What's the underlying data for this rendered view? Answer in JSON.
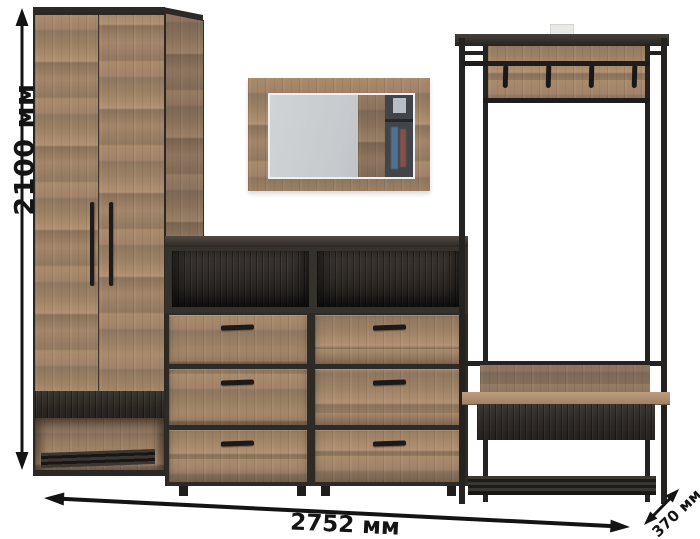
{
  "image": {
    "background": "#ffffff",
    "subject": "Hallway furniture set render: wardrobe, wall mirror, chest of drawers, coat rack with bench"
  },
  "dimensions": {
    "height_label": "2100 мм",
    "width_label": "2752 мм",
    "depth_label": "370 мм"
  },
  "furniture": {
    "wardrobe": {
      "doors": 2
    },
    "dresser": {
      "drawers": 6,
      "open_shelves": 2
    },
    "coat_rack": {
      "hooks": 4,
      "has_bench": true
    },
    "mirror": {
      "count": 1
    }
  },
  "palette": {
    "wood": "#a5876a",
    "dark_wood": "#2f2b27",
    "metal_frame": "#242322",
    "annotation": "#141414",
    "mirror_glass": "#c7ccd1"
  }
}
